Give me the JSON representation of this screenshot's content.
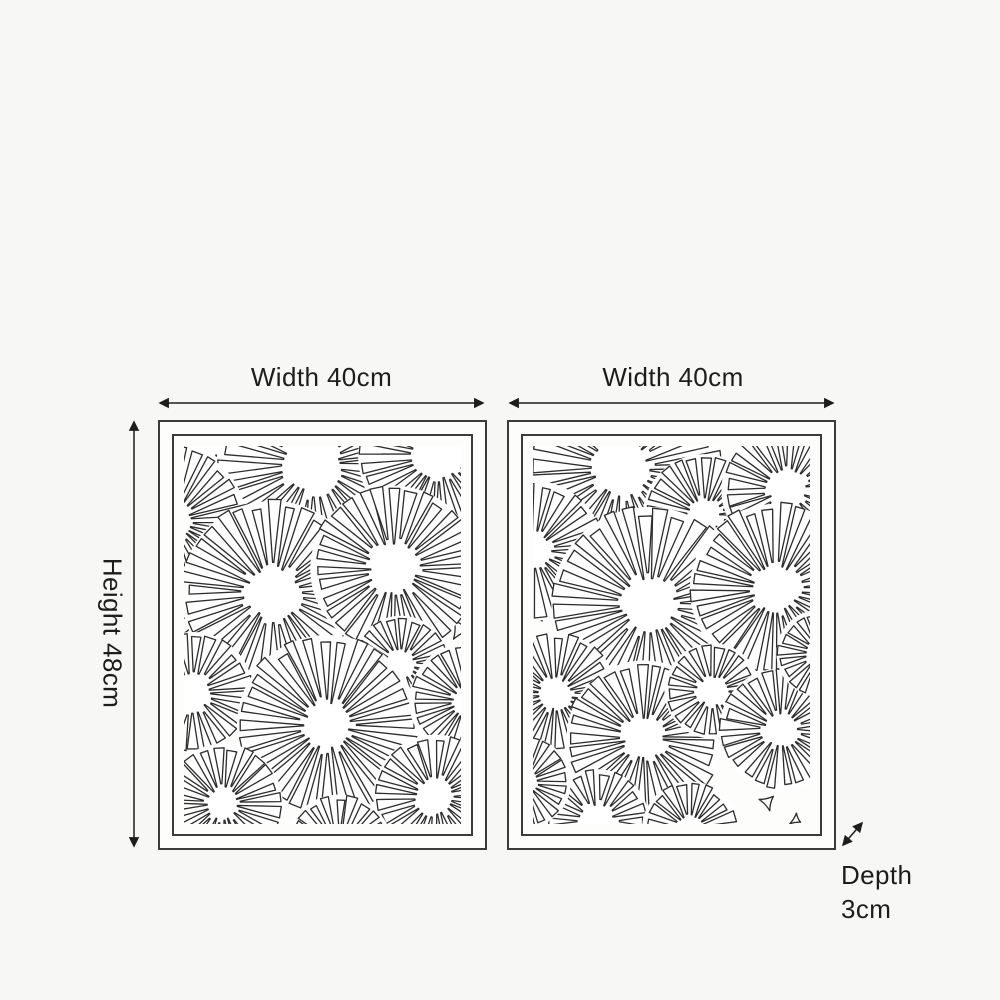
{
  "page": {
    "background": "#f7f7f5"
  },
  "diagram": {
    "colors": {
      "pattern_line": "#2e2e2e",
      "frame_border": "#3b3b3b",
      "arrow": "#1d1d1d",
      "text": "#1d1d1d",
      "panel_fill": "#fdfdfc"
    },
    "dimensions": {
      "width_left": {
        "label": "Width 40cm"
      },
      "width_right": {
        "label": "Width 40cm"
      },
      "height": {
        "label": "Height 48cm"
      },
      "depth": {
        "line1": "Depth",
        "line2": "3cm"
      }
    },
    "panels": [
      {
        "name": "left-panel",
        "seed": 7,
        "viewbox": [
          272,
          372
        ],
        "circles": [
          {
            "x": 16,
            "y": 2,
            "r": 58
          },
          {
            "x": 127,
            "y": 18,
            "r": 92
          },
          {
            "x": 250,
            "y": 10,
            "r": 76
          },
          {
            "x": -12,
            "y": 74,
            "r": 70
          },
          {
            "x": 87,
            "y": 144,
            "r": 87
          },
          {
            "x": 206,
            "y": 121,
            "r": 79
          },
          {
            "x": 213,
            "y": 214,
            "r": 44
          },
          {
            "x": 8,
            "y": 243,
            "r": 57
          },
          {
            "x": 141,
            "y": 275,
            "r": 86
          },
          {
            "x": 278,
            "y": 251,
            "r": 54
          },
          {
            "x": 38,
            "y": 352,
            "r": 56
          },
          {
            "x": 247,
            "y": 345,
            "r": 58
          },
          {
            "x": 152,
            "y": 396,
            "r": 50
          }
        ],
        "shapes": [
          {
            "x": 55,
            "y": 70,
            "s": 16,
            "rot": 15,
            "n": 3
          },
          {
            "x": 131,
            "y": 91,
            "s": 13,
            "rot": 200,
            "n": 3
          },
          {
            "x": 194,
            "y": 33,
            "s": 14,
            "rot": 95,
            "n": 3
          },
          {
            "x": 268,
            "y": 62,
            "s": 11,
            "rot": 0,
            "n": 3
          },
          {
            "x": 9,
            "y": 124,
            "s": 12,
            "rot": 50,
            "n": 3
          },
          {
            "x": 163,
            "y": 193,
            "s": 13,
            "rot": 330,
            "n": 3
          },
          {
            "x": 69,
            "y": 232,
            "s": 18,
            "rot": 0,
            "n": 4
          },
          {
            "x": 271,
            "y": 180,
            "s": 11,
            "rot": 240,
            "n": 3
          },
          {
            "x": 204,
            "y": 332,
            "s": 12,
            "rot": 25,
            "n": 3
          },
          {
            "x": 3,
            "y": 321,
            "s": 10,
            "rot": 80,
            "n": 3
          },
          {
            "x": 2,
            "y": 165,
            "s": 6,
            "rot": 0,
            "n": 3
          },
          {
            "x": 6,
            "y": 183,
            "s": 5,
            "rot": 45,
            "n": 3
          },
          {
            "x": 3,
            "y": 199,
            "s": 5,
            "rot": 90,
            "n": 3
          }
        ]
      },
      {
        "name": "right-panel",
        "seed": 13,
        "viewbox": [
          272,
          372
        ],
        "circles": [
          {
            "x": -6,
            "y": 4,
            "r": 56
          },
          {
            "x": 87,
            "y": 22,
            "r": 93
          },
          {
            "x": 168,
            "y": 68,
            "r": 57
          },
          {
            "x": 250,
            "y": 43,
            "r": 62
          },
          {
            "x": 0,
            "y": 103,
            "r": 66
          },
          {
            "x": 114,
            "y": 156,
            "r": 93
          },
          {
            "x": 238,
            "y": 141,
            "r": 81
          },
          {
            "x": 22,
            "y": 244,
            "r": 57
          },
          {
            "x": 109,
            "y": 287,
            "r": 73
          },
          {
            "x": 176,
            "y": 241,
            "r": 44
          },
          {
            "x": 243,
            "y": 279,
            "r": 57
          },
          {
            "x": 63,
            "y": 369,
            "r": 48
          },
          {
            "x": 154,
            "y": 377,
            "r": 44
          },
          {
            "x": 282,
            "y": 204,
            "r": 40
          },
          {
            "x": -8,
            "y": 331,
            "r": 42
          }
        ],
        "shapes": [
          {
            "x": 18,
            "y": 66,
            "s": 13,
            "rot": 30,
            "n": 3
          },
          {
            "x": 62,
            "y": 111,
            "s": 12,
            "rot": 190,
            "n": 3
          },
          {
            "x": 165,
            "y": 121,
            "s": 12,
            "rot": 300,
            "n": 3
          },
          {
            "x": 206,
            "y": 79,
            "s": 16,
            "rot": 10,
            "n": 4
          },
          {
            "x": 230,
            "y": 221,
            "s": 12,
            "rot": 45,
            "n": 3
          },
          {
            "x": 2,
            "y": 161,
            "s": 12,
            "rot": 60,
            "n": 3
          },
          {
            "x": 230,
            "y": 350,
            "s": 9,
            "rot": 80,
            "n": 3
          },
          {
            "x": 268,
            "y": 4,
            "s": 6,
            "rot": 0,
            "n": 3
          },
          {
            "x": 258,
            "y": 368,
            "s": 6,
            "rot": 30,
            "n": 3
          }
        ]
      }
    ]
  }
}
